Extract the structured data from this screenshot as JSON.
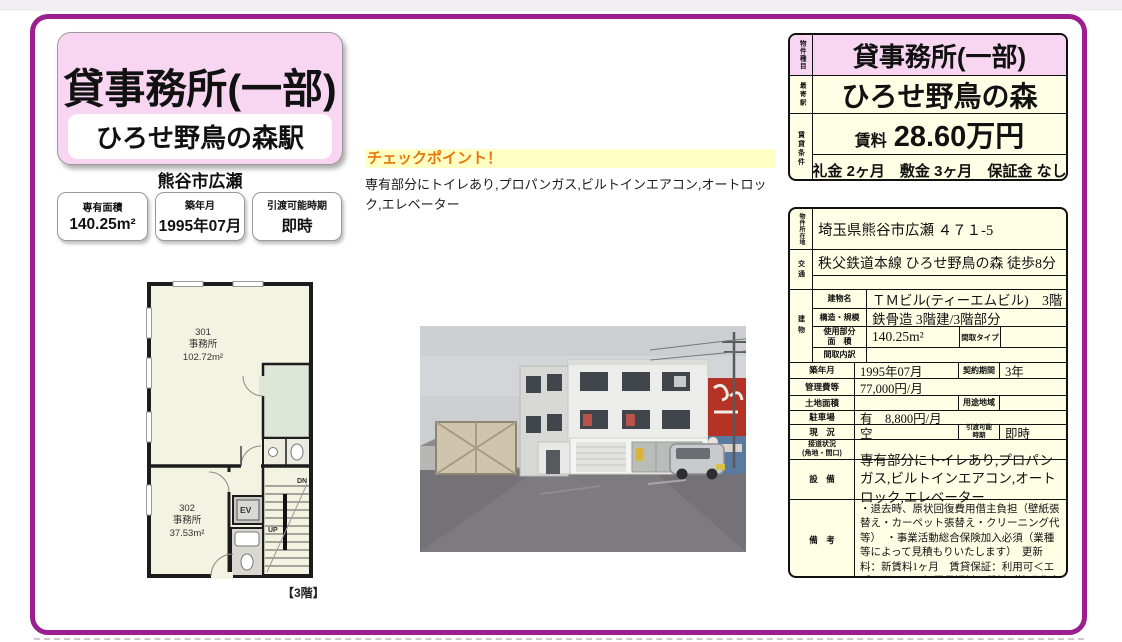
{
  "colors": {
    "accent_purple": "#9b1f8e",
    "banner_pink": "#f8d6f2",
    "table_cream": "#ffffe6",
    "checkpoint_yellow": "#ffffc4",
    "checkpoint_orange": "#e5780a"
  },
  "banner": {
    "title": "貸事務所(一部)",
    "station": "ひろせ野鳥の森駅",
    "city": "熊谷市広瀬"
  },
  "stats": [
    {
      "label": "専有面積",
      "value": "140.25m²"
    },
    {
      "label": "築年月",
      "value": "1995年07月"
    },
    {
      "label": "引渡可能時期",
      "value": "即時"
    }
  ],
  "checkpoint": {
    "title": "チェックポイント！",
    "body": "専有部分にトイレあり,プロパンガス,ビルトインエアコン,オートロック,エレベーター"
  },
  "floorplan": {
    "room301": "301\n事務所\n102.72m²",
    "room302": "302\n事務所\n37.53m²",
    "ev": "EV",
    "dn": "DN",
    "up": "UP",
    "caption": "【3階】"
  },
  "summary": {
    "type_label": "物件種目",
    "type_value": "貸事務所(一部)",
    "station_label": "最寄駅",
    "station_value": "ひろせ野鳥の森",
    "terms_label": "賃貸条件",
    "rent_label": "賃料",
    "rent_value": "28.60万円",
    "fees": "礼金 2ヶ月　敷金 3ヶ月　保証金 なし"
  },
  "details": {
    "location_label": "物件所在地",
    "location": "埼玉県熊谷市広瀬 ４７１-5",
    "access_label": "交通",
    "access": "秩父鉄道本線 ひろせ野鳥の森 徒歩8分",
    "access2": "",
    "building_label": "建物",
    "bname_label": "建物名",
    "bname": "ＴＭビル(ティーエムビル)　3階",
    "structure_label": "構造・規模",
    "structure": "鉄骨造 3階建/3階部分",
    "area_label": "使用部分\n面　積",
    "area": "140.25m²",
    "madori_type_label": "間取タイプ",
    "madori_type": "",
    "madori_label": "間取内訳",
    "madori": "",
    "built_label": "築年月",
    "built": "1995年07月",
    "contract_label": "契約期間",
    "contract": "3年",
    "mgmt_label": "管理費等",
    "mgmt": "77,000円/月",
    "land_label": "土地面積",
    "land": "",
    "zoning_label": "用途地域",
    "zoning": "",
    "parking_label": "駐車場",
    "parking": "有　8,800円/月",
    "status_label": "現　況",
    "status": "空",
    "handover_label": "引渡可能\n時期",
    "handover": "即時",
    "road_label": "接道状況\n(角地・間口)",
    "road": "",
    "equip_label": "設　備",
    "equip": "専有部分にトイレあり,プロパンガス,ビルトインエアコン,オートロック,エレベーター",
    "notes_label": "備　考",
    "notes": "・退去時、原状回復費用借主負担（壁紙張替え・カーペット張替え・クリーニング代等）　・事業活動総合保険加入必須（業種等によって見積もりいたします）　更新料：新賃料1ヶ月　賃貸保証：利用可＜エポスカード＞初回保証料：賃料（管理費含む）の１００％　月次保証料：１，０００円"
  }
}
